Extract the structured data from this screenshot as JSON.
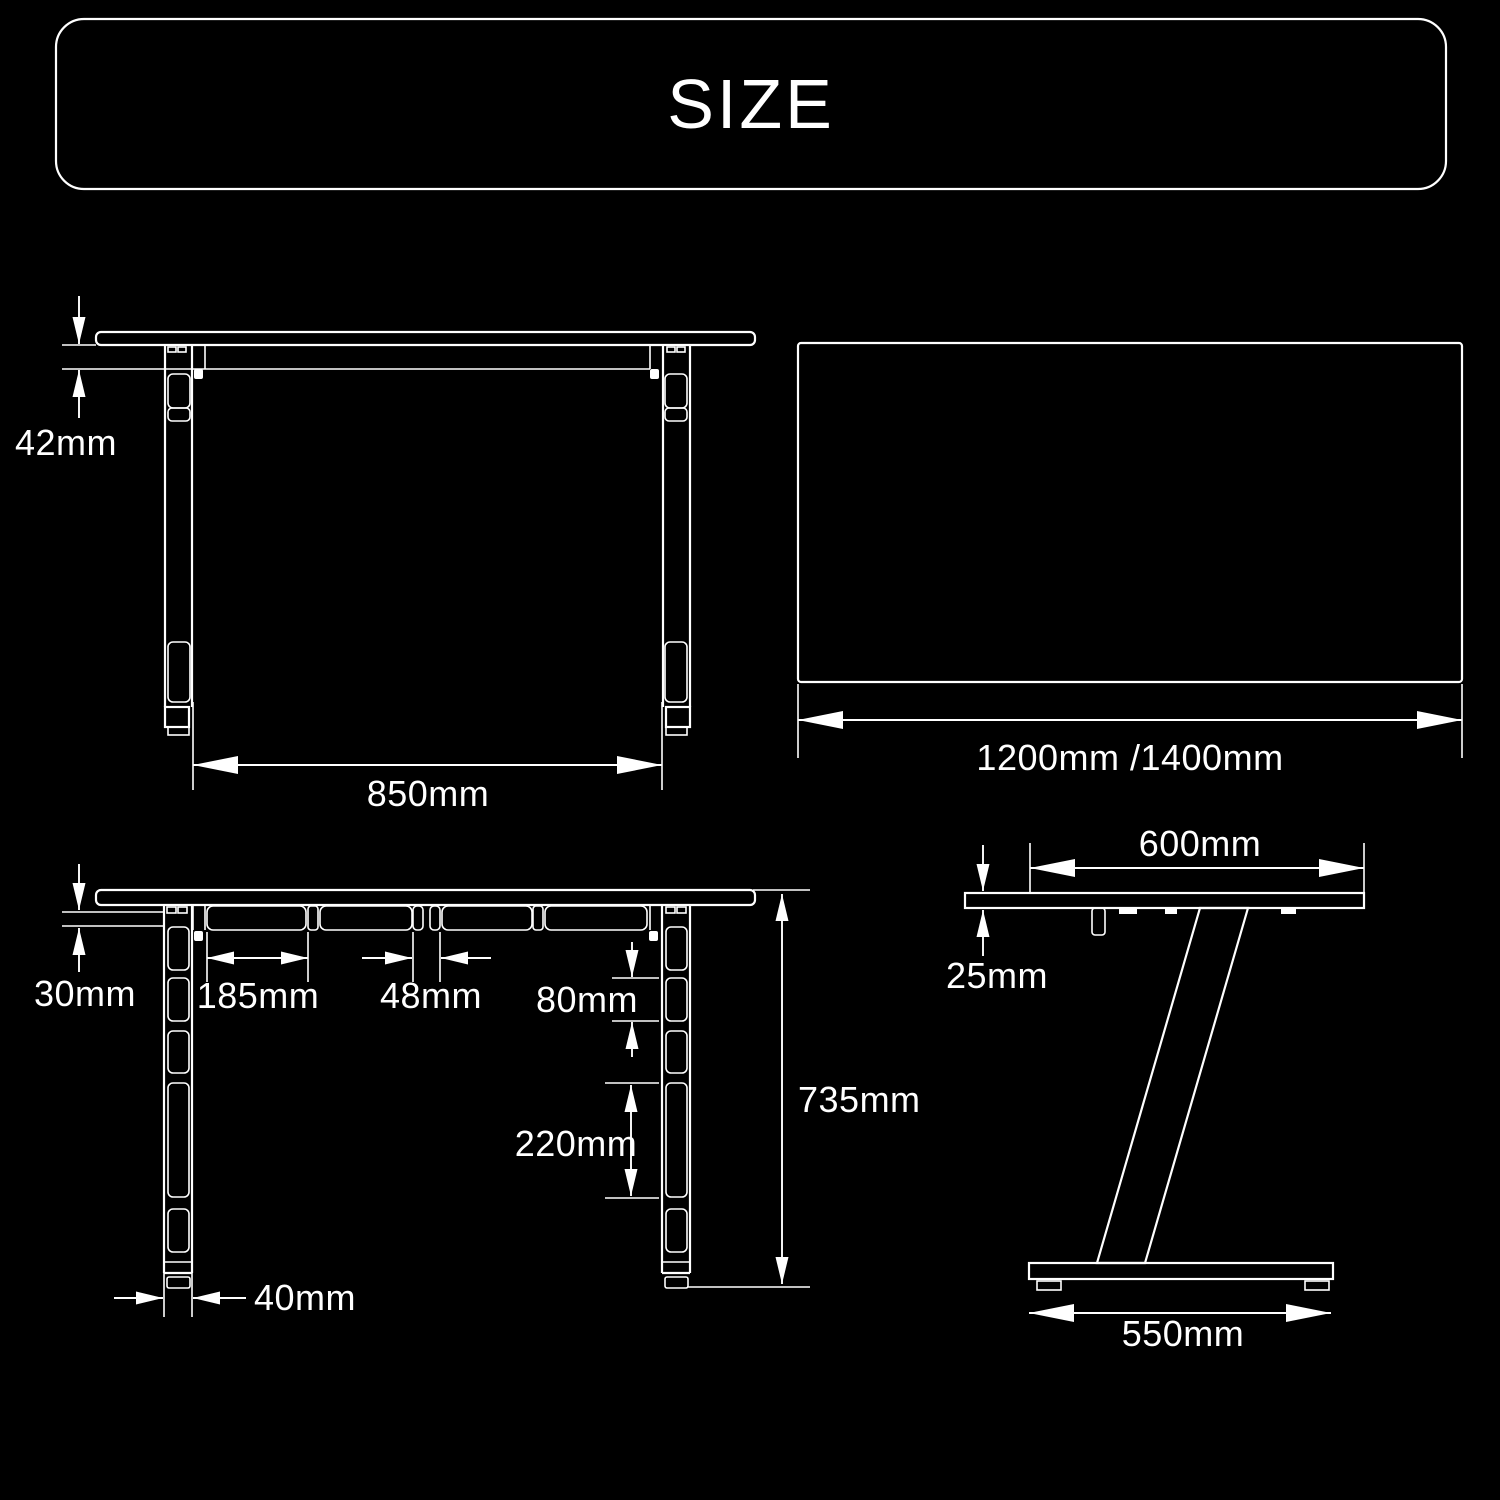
{
  "header": {
    "title": "SIZE"
  },
  "colors": {
    "background": "#000000",
    "line": "#ffffff",
    "text": "#ffffff"
  },
  "views": {
    "front_view": {
      "name": "desk front view",
      "labels": {
        "frame_thickness": "42mm",
        "leg_inner_width": "850mm"
      }
    },
    "top_view": {
      "name": "desktop top view",
      "labels": {
        "width": "1200mm /1400mm"
      }
    },
    "front_detail_view": {
      "name": "desk front detail view",
      "labels": {
        "frame_thickness": "30mm",
        "beam_segment_length": "185mm",
        "center_support_width": "48mm",
        "upper_slot_spacing": "80mm",
        "lower_slot_spacing": "220mm",
        "desk_height": "735mm",
        "leg_width": "40mm"
      }
    },
    "side_view": {
      "name": "desk side view",
      "labels": {
        "desktop_depth": "600mm",
        "desktop_thickness": "25mm",
        "base_depth": "550mm"
      }
    }
  }
}
